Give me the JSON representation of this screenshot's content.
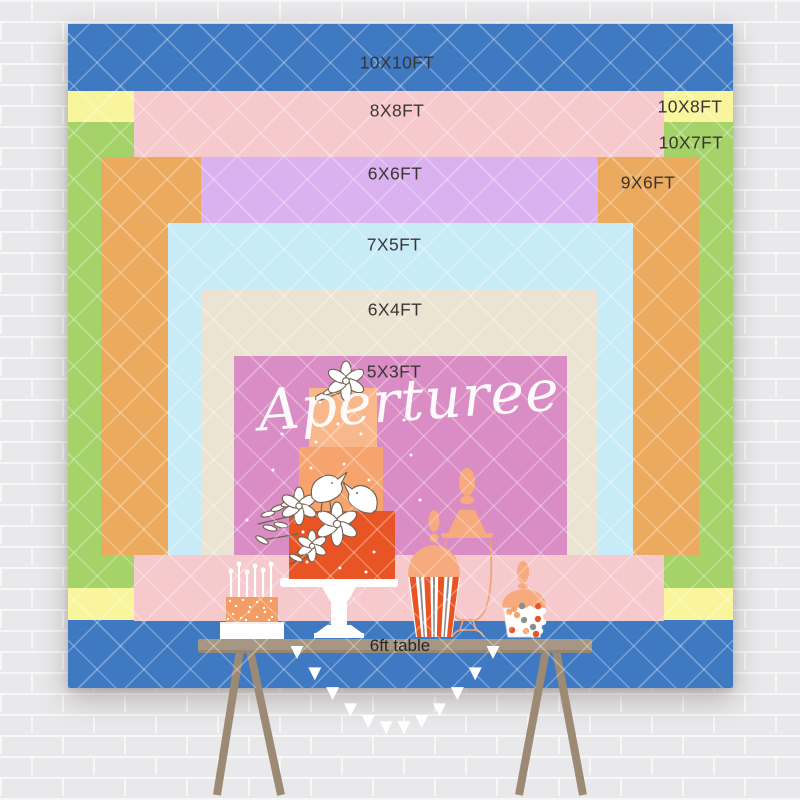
{
  "watermark": {
    "text": "Aperturee"
  },
  "backdrop": {
    "layers": [
      {
        "label": "10X10FT",
        "color": "#3e79c2",
        "x": 68,
        "y": 24,
        "w": 665,
        "h": 664,
        "lx": 397,
        "ly": 63
      },
      {
        "label": "10X8FT",
        "color": "#f9f59d",
        "x": 68,
        "y": 91,
        "w": 665,
        "h": 529,
        "lx": 690,
        "ly": 107
      },
      {
        "label": "10X7FT",
        "color": "#a6d26a",
        "x": 68,
        "y": 122,
        "w": 665,
        "h": 466,
        "lx": 691,
        "ly": 143
      },
      {
        "label": "8X8FT",
        "color": "#f6c9cd",
        "x": 134,
        "y": 91,
        "w": 530,
        "h": 530,
        "lx": 397,
        "ly": 111
      },
      {
        "label": "9X6FT",
        "color": "#ecaa5e",
        "x": 101,
        "y": 157,
        "w": 598,
        "h": 398,
        "lx": 648,
        "ly": 183
      },
      {
        "label": "6X6FT",
        "color": "#d9b2ef",
        "x": 201,
        "y": 157,
        "w": 397,
        "h": 398,
        "lx": 395,
        "ly": 174
      },
      {
        "label": "7X5FT",
        "color": "#c8ebf8",
        "x": 168,
        "y": 223,
        "w": 465,
        "h": 332,
        "lx": 394,
        "ly": 245
      },
      {
        "label": "6X4FT",
        "color": "#ebe4d3",
        "x": 201,
        "y": 289,
        "w": 397,
        "h": 266,
        "lx": 395,
        "ly": 310
      },
      {
        "label": "5X3FT",
        "color": "#da8cc4",
        "x": 234,
        "y": 356,
        "w": 333,
        "h": 199,
        "lx": 394,
        "ly": 372
      }
    ]
  },
  "table": {
    "label": "6ft table"
  },
  "colors": {
    "brick": "#e9e8ea",
    "mortar": "#f8f7f8",
    "lattice": "rgba(255,255,255,0.30)",
    "label_text": "#3a3533",
    "table_text": "#262626",
    "watermark": "#ffffff",
    "table_top": "#a79683",
    "table_leg": "#9c8a74",
    "cake_top": "#f9b88c",
    "cake_mid": "#f6a36e",
    "cake_accent": "#e95424",
    "peach": "#f6aa7d",
    "peach_line": "#f0a16f",
    "small_cake": "#f29d63",
    "outline": "#6f604f",
    "candy_gray": "#8d8d8d"
  }
}
